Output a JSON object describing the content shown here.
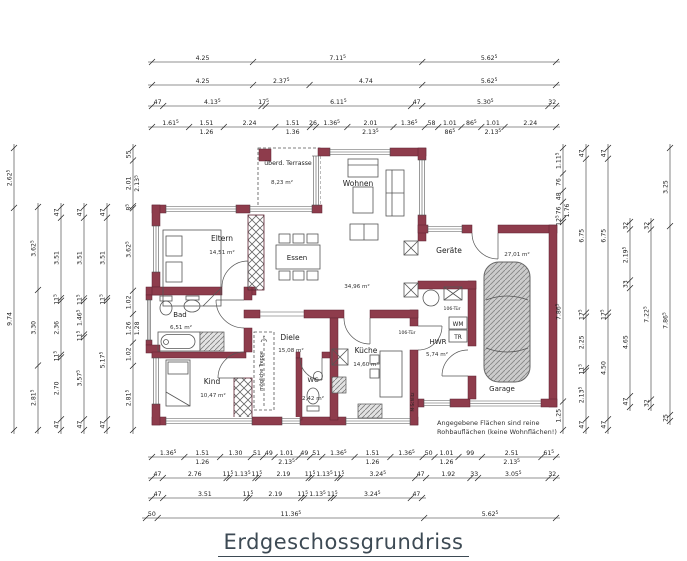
{
  "title": "Erdgeschossgrundriss",
  "note": {
    "line1": "Angegebene Flächen sind reine",
    "line2": "Rohbauflächen (keine Wohnflächen!)"
  },
  "colors": {
    "wall": "#8e3c4c",
    "wall_stroke": "#5e2130",
    "dim": "#222222",
    "title": "#3d4a54"
  },
  "rooms": [
    {
      "id": "terrasse",
      "name": "überd. Terrasse",
      "area": "8,23 m²",
      "x": 288,
      "y": 165,
      "ax": 282,
      "ay": 184,
      "fs": 6.2
    },
    {
      "id": "wohnen",
      "name": "Wohnen",
      "area": "34,96 m²",
      "x": 358,
      "y": 186,
      "ax": 357,
      "ay": 288
    },
    {
      "id": "eltern",
      "name": "Eltern",
      "area": "14,51 m²",
      "x": 222,
      "y": 241,
      "ax": 222,
      "ay": 254
    },
    {
      "id": "essen",
      "name": "Essen",
      "area": "",
      "x": 297,
      "y": 260,
      "ax": 0,
      "ay": 0,
      "fs": 7
    },
    {
      "id": "bad",
      "name": "Bad",
      "area": "6,51 m²",
      "x": 180,
      "y": 317,
      "ax": 181,
      "ay": 329,
      "fs": 7
    },
    {
      "id": "kind",
      "name": "Kind",
      "area": "10,47 m²",
      "x": 212,
      "y": 384,
      "ax": 213,
      "ay": 397
    },
    {
      "id": "diele",
      "name": "Diele",
      "area": "15,08 m²",
      "x": 290,
      "y": 340,
      "ax": 291,
      "ay": 352
    },
    {
      "id": "wc",
      "name": "WC",
      "area": "2,42 m²",
      "x": 313,
      "y": 382,
      "ax": 313,
      "ay": 400,
      "fs": 6.5
    },
    {
      "id": "kueche",
      "name": "Küche",
      "area": "14,60 m²",
      "x": 366,
      "y": 353,
      "ax": 366,
      "ay": 366
    },
    {
      "id": "hwr",
      "name": "HWR",
      "area": "5,74 m²",
      "x": 438,
      "y": 344,
      "ax": 437,
      "ay": 356,
      "fs": 7
    },
    {
      "id": "geraete",
      "name": "Geräte",
      "area": "27,01 m²",
      "x": 449,
      "y": 253,
      "ax": 517,
      "ay": 256
    },
    {
      "id": "garage",
      "name": "Garage",
      "area": "",
      "x": 502,
      "y": 391,
      "ax": 0,
      "ay": 0,
      "fs": 7
    }
  ],
  "labels": [
    {
      "text": "106-Tür",
      "x": 407,
      "y": 334,
      "fs": 4.6
    },
    {
      "text": "106-Tür",
      "x": 452,
      "y": 310,
      "fs": 4.6
    },
    {
      "text": "mögliche Treppe",
      "x": 263,
      "y": 371,
      "rot": -90,
      "fs": 4.8
    },
    {
      "text": "M-Schlitz",
      "x": 414,
      "y": 402,
      "rot": -90,
      "fs": 4.2
    },
    {
      "text": "WM",
      "x": 458,
      "y": 326,
      "fs": 5.8
    },
    {
      "text": "TR",
      "x": 458,
      "y": 339,
      "fs": 5.8
    }
  ],
  "dims": {
    "top": [
      {
        "y": 62,
        "x1": 152,
        "x2": 556,
        "segs": [
          "4.25",
          "7.11^5",
          "5.62^5"
        ]
      },
      {
        "y": 85,
        "x1": 152,
        "x2": 556,
        "segs": [
          "4.25",
          "2.37^5",
          "4.74",
          "5.62^5"
        ]
      },
      {
        "y": 106,
        "x1": 152,
        "x2": 556,
        "segs": [
          "47",
          "4.13^5",
          "17^5",
          "6.11^5",
          "47",
          "5.30^5",
          "32"
        ]
      },
      {
        "y": 127,
        "x1": 152,
        "x2": 556,
        "segs": [
          "1.61^5",
          "1.51|1.26",
          "2.24",
          "1.51|1.36",
          "26",
          "1.36^5",
          "2.01|2.13^5",
          "1.36^5",
          "58",
          "1.01|86^5",
          "86^5",
          "1.01|2.13^5",
          "2.24"
        ]
      }
    ],
    "bottom": [
      {
        "y": 457,
        "x1": 152,
        "x2": 556,
        "segs": [
          "1.36^5",
          "1.51|1.26",
          "1.30",
          "51",
          "49",
          "1.01|2.13^5",
          "49",
          "51",
          "1.36^5",
          "1.51|1.26",
          "1.36^5",
          "50",
          "1.01|1.26",
          "99",
          "2.51|2.13^5",
          "61^5"
        ]
      },
      {
        "y": 478,
        "x1": 152,
        "x2": 556,
        "segs": [
          "47",
          "2.76",
          "11^5",
          "1.13^5",
          "11^5",
          "2.19",
          "11^5",
          "1.13^5",
          "11^5",
          "3.24^5",
          "47",
          "1.92",
          "33",
          "3.05^5",
          "32"
        ]
      },
      {
        "y": 498,
        "x1": 152,
        "x2": 422,
        "segs": [
          "47",
          "3.51",
          "11^5",
          "2.19",
          "11^5",
          "1.13^5",
          "11^5",
          "3.24^5",
          "47"
        ]
      },
      {
        "y": 518,
        "x1": 146,
        "x2": 556,
        "segs": [
          "50",
          "11.36^5",
          "5.62^5"
        ]
      }
    ],
    "left": [
      {
        "x": 14,
        "y1": 148,
        "y2": 430,
        "segs": [
          "2.62^5",
          "9.74"
        ]
      },
      {
        "x": 38,
        "y1": 207,
        "y2": 430,
        "segs": [
          "3.62^5",
          "3.30",
          "2.81^5"
        ]
      },
      {
        "x": 61,
        "y1": 207,
        "y2": 430,
        "segs": [
          "47",
          "3.51",
          "11^5",
          "2.36",
          "11^5",
          "2.70",
          "47"
        ]
      },
      {
        "x": 84,
        "y1": 207,
        "y2": 430,
        "segs": [
          "47",
          "3.51",
          "11^5",
          "1.46^5",
          "11^5",
          "3.57^5",
          "47"
        ]
      },
      {
        "x": 107,
        "y1": 207,
        "y2": 430,
        "segs": [
          "47",
          "3.51",
          "11^5",
          "5.17^5",
          "47"
        ]
      },
      {
        "x": 133,
        "y1": 148,
        "y2": 430,
        "segs": [
          "55",
          "2.01|2.13^5",
          "8^5",
          "3.62^5",
          "1.02",
          "1.26|1.28",
          "1.02",
          "2.81^5"
        ]
      }
    ],
    "right": [
      {
        "x": 563,
        "y1": 148,
        "y2": 430,
        "segs": [
          "1.11^5",
          "76",
          "48",
          "76|1.76",
          "12^5",
          "7.86^5",
          "1.25"
        ]
      },
      {
        "x": 586,
        "y1": 148,
        "y2": 430,
        "segs": [
          "47",
          "6.75",
          "17^5",
          "2.25",
          "11^5",
          "2.13^5",
          "47"
        ]
      },
      {
        "x": 608,
        "y1": 148,
        "y2": 430,
        "segs": [
          "47",
          "6.75",
          "17^5",
          "4.50",
          "47"
        ]
      },
      {
        "x": 630,
        "y1": 222,
        "y2": 407,
        "segs": [
          "32",
          "2.19^5",
          "33",
          "4.65",
          "47"
        ]
      },
      {
        "x": 651,
        "y1": 222,
        "y2": 407,
        "segs": [
          "32",
          "7.22^5",
          "32"
        ]
      },
      {
        "x": 670,
        "y1": 148,
        "y2": 421,
        "segs": [
          "3.25",
          "7.86^5",
          "25"
        ]
      }
    ]
  }
}
